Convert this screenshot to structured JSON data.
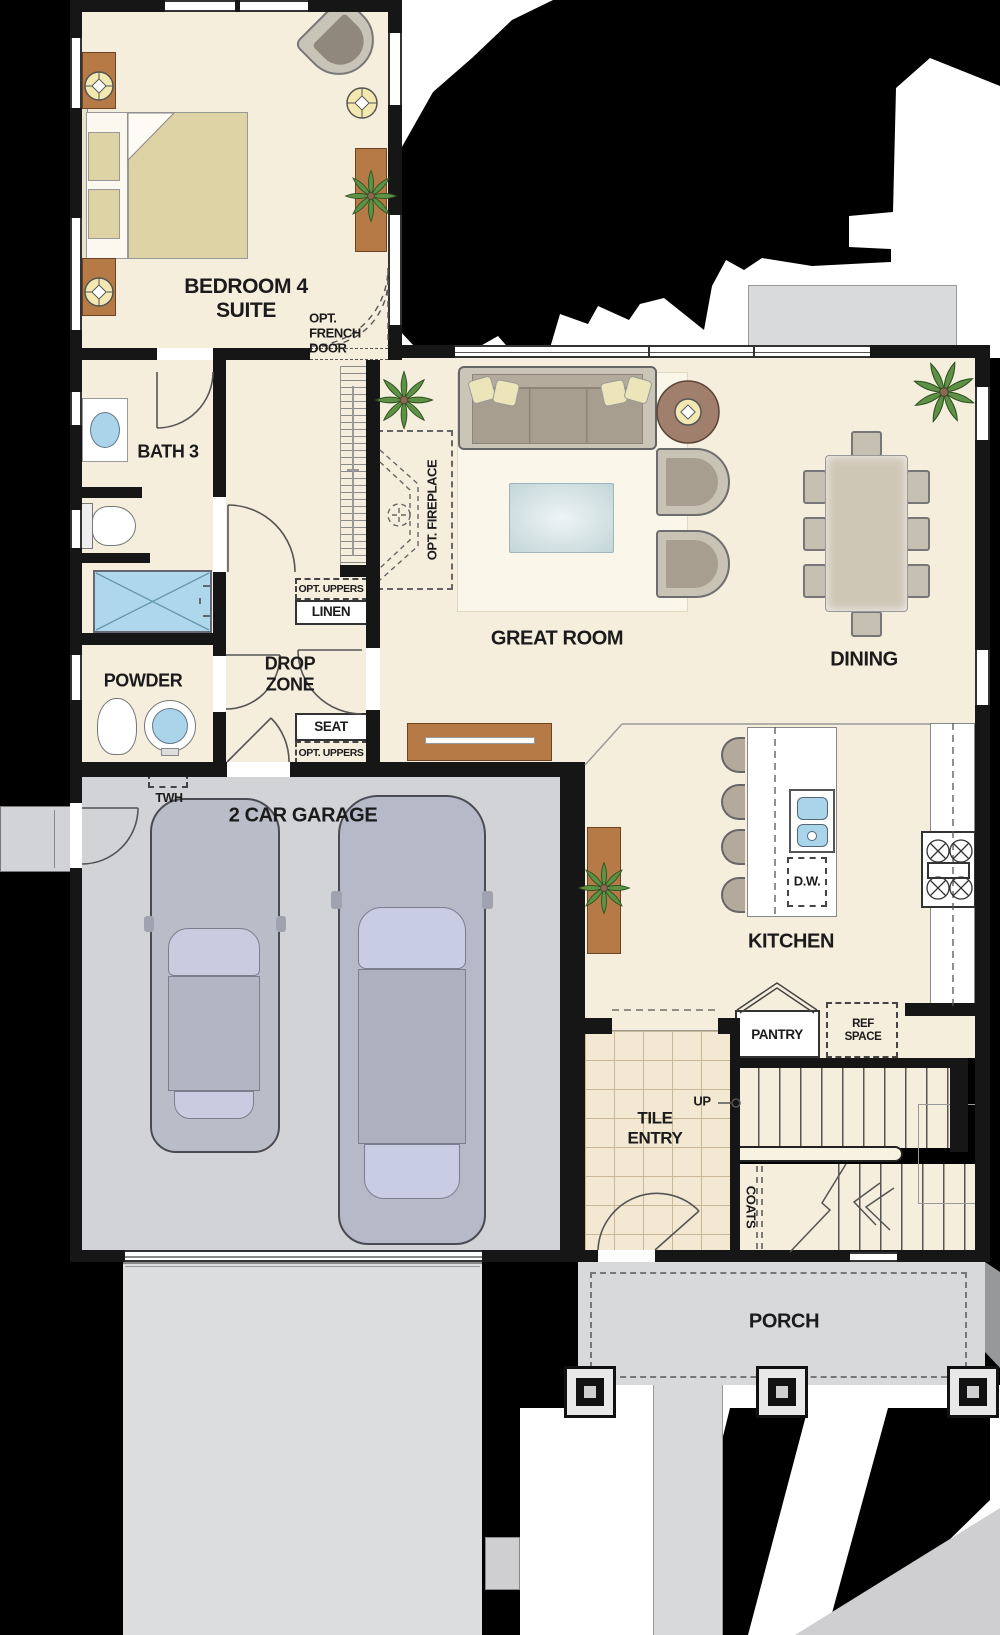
{
  "colors": {
    "background": "#000000",
    "wall": "#161616",
    "room_fill": "#f6eedd",
    "tile_fill": "#f3e9d3",
    "garage_floor": "#d2d3d6",
    "driveway": "#dcdddf",
    "porch": "#d8d9db",
    "water_blue": "#a9d4e9",
    "wood_brown": "#b57a45",
    "plant_green": "#5d9143",
    "label_text": "#1b1b1b"
  },
  "labels": {
    "bedroom4_line1": "BEDROOM 4",
    "bedroom4_line2": "SUITE",
    "opt_french_1": "OPT.",
    "opt_french_2": "FRENCH",
    "opt_french_3": "DOOR",
    "bath3": "BATH 3",
    "powder": "POWDER",
    "drop_1": "DROP",
    "drop_2": "ZONE",
    "opt_uppers_top": "OPT. UPPERS",
    "linen": "LINEN",
    "seat": "SEAT",
    "opt_uppers_bottom": "OPT. UPPERS",
    "twh": "TWH",
    "garage": "2 CAR GARAGE",
    "opt_fireplace": "OPT. FIREPLACE",
    "great_room": "GREAT ROOM",
    "dining": "DINING",
    "kitchen": "KITCHEN",
    "dw": "D.W.",
    "pantry": "PANTRY",
    "ref_1": "REF",
    "ref_2": "SPACE",
    "tile_1": "TILE",
    "tile_2": "ENTRY",
    "up": "UP",
    "coats": "COATS",
    "porch": "PORCH"
  }
}
